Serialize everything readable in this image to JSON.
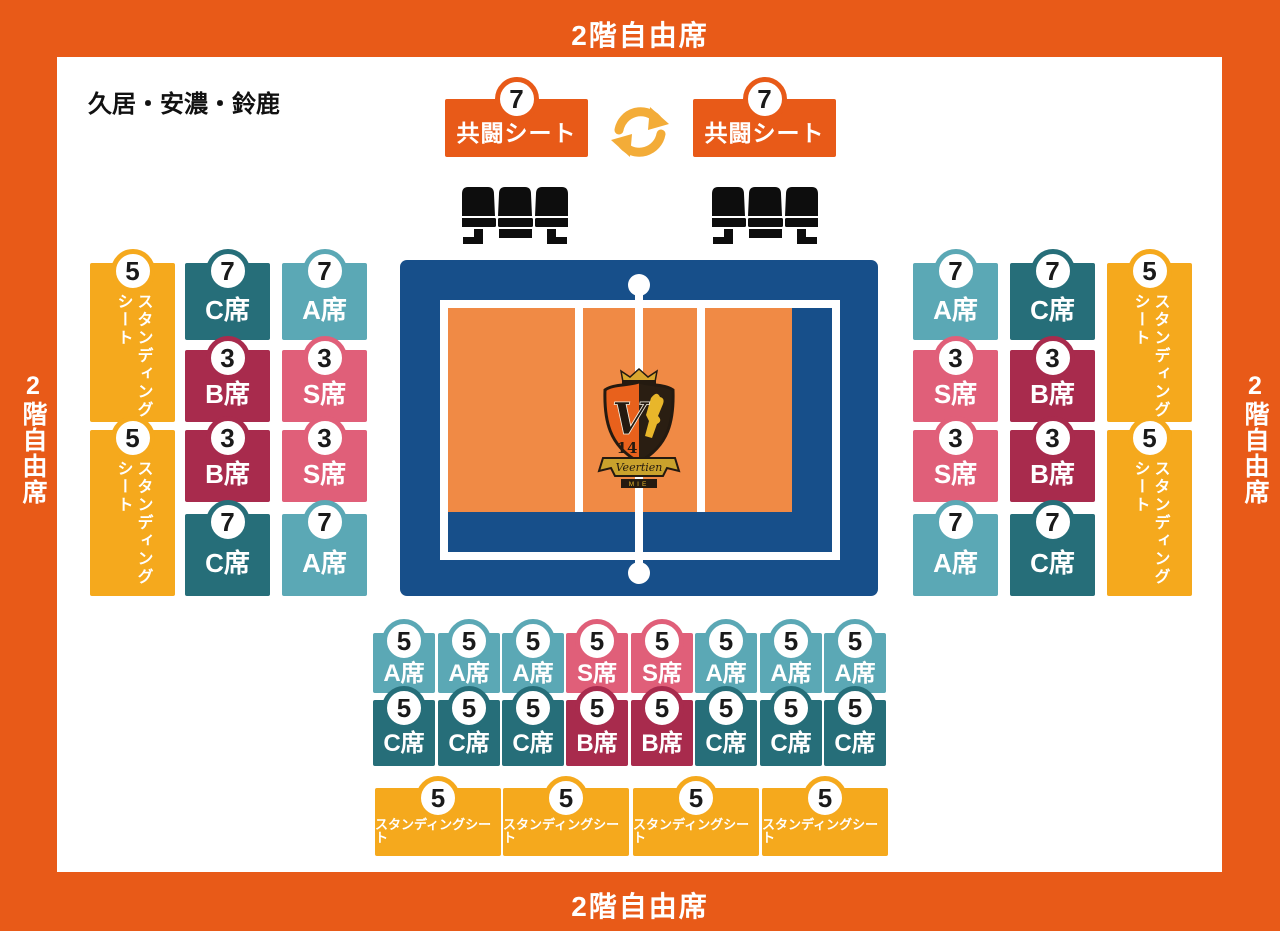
{
  "colors": {
    "orange": "#E85A18",
    "yellow": "#F5A91D",
    "teal_light": "#5BA8B5",
    "teal_dark": "#266E79",
    "pink": "#E05F79",
    "crimson": "#A82B4D",
    "court_blue": "#174F8A",
    "court_orange": "#F08A45",
    "arrow_yellow": "#F3AC38",
    "badge_text": "#1A1A1A"
  },
  "frame": {
    "top": "2階自由席",
    "bottom": "2階自由席",
    "left": "2階自由席",
    "right": "2階自由席"
  },
  "area_label": "久居・安濃・鈴鹿",
  "icons": {
    "swap": "circular-swap-arrows",
    "bench": "triple-seat-bench"
  },
  "kyoto": [
    {
      "label": "共闘シート",
      "badge": "7"
    },
    {
      "label": "共闘シート",
      "badge": "7"
    }
  ],
  "seats": {
    "left": [
      {
        "badge": "5",
        "label": "スタンディング\nシート"
      },
      {
        "badge": "5",
        "label": "スタンディング\nシート"
      },
      {
        "badge": "7",
        "label": "C席"
      },
      {
        "badge": "3",
        "label": "B席"
      },
      {
        "badge": "3",
        "label": "B席"
      },
      {
        "badge": "7",
        "label": "C席"
      },
      {
        "badge": "7",
        "label": "A席"
      },
      {
        "badge": "3",
        "label": "S席"
      },
      {
        "badge": "3",
        "label": "S席"
      },
      {
        "badge": "7",
        "label": "A席"
      }
    ],
    "right": [
      {
        "badge": "7",
        "label": "A席"
      },
      {
        "badge": "3",
        "label": "S席"
      },
      {
        "badge": "3",
        "label": "S席"
      },
      {
        "badge": "7",
        "label": "A席"
      },
      {
        "badge": "7",
        "label": "C席"
      },
      {
        "badge": "3",
        "label": "B席"
      },
      {
        "badge": "3",
        "label": "B席"
      },
      {
        "badge": "7",
        "label": "C席"
      },
      {
        "badge": "5",
        "label": "スタンディング\nシート"
      },
      {
        "badge": "5",
        "label": "スタンディング\nシート"
      }
    ],
    "bottom_row1": [
      {
        "badge": "5",
        "label": "A席"
      },
      {
        "badge": "5",
        "label": "A席"
      },
      {
        "badge": "5",
        "label": "A席"
      },
      {
        "badge": "5",
        "label": "S席"
      },
      {
        "badge": "5",
        "label": "S席"
      },
      {
        "badge": "5",
        "label": "A席"
      },
      {
        "badge": "5",
        "label": "A席"
      },
      {
        "badge": "5",
        "label": "A席"
      }
    ],
    "bottom_row2": [
      {
        "badge": "5",
        "label": "C席"
      },
      {
        "badge": "5",
        "label": "C席"
      },
      {
        "badge": "5",
        "label": "C席"
      },
      {
        "badge": "5",
        "label": "B席"
      },
      {
        "badge": "5",
        "label": "B席"
      },
      {
        "badge": "5",
        "label": "C席"
      },
      {
        "badge": "5",
        "label": "C席"
      },
      {
        "badge": "5",
        "label": "C席"
      }
    ],
    "bottom_stand": [
      {
        "badge": "5",
        "label": "スタンディングシート"
      },
      {
        "badge": "5",
        "label": "スタンディングシート"
      },
      {
        "badge": "5",
        "label": "スタンディングシート"
      },
      {
        "badge": "5",
        "label": "スタンディングシート"
      }
    ]
  },
  "logo": {
    "initial": "V",
    "number": "14",
    "name": "Veertien",
    "region": "MIE"
  }
}
